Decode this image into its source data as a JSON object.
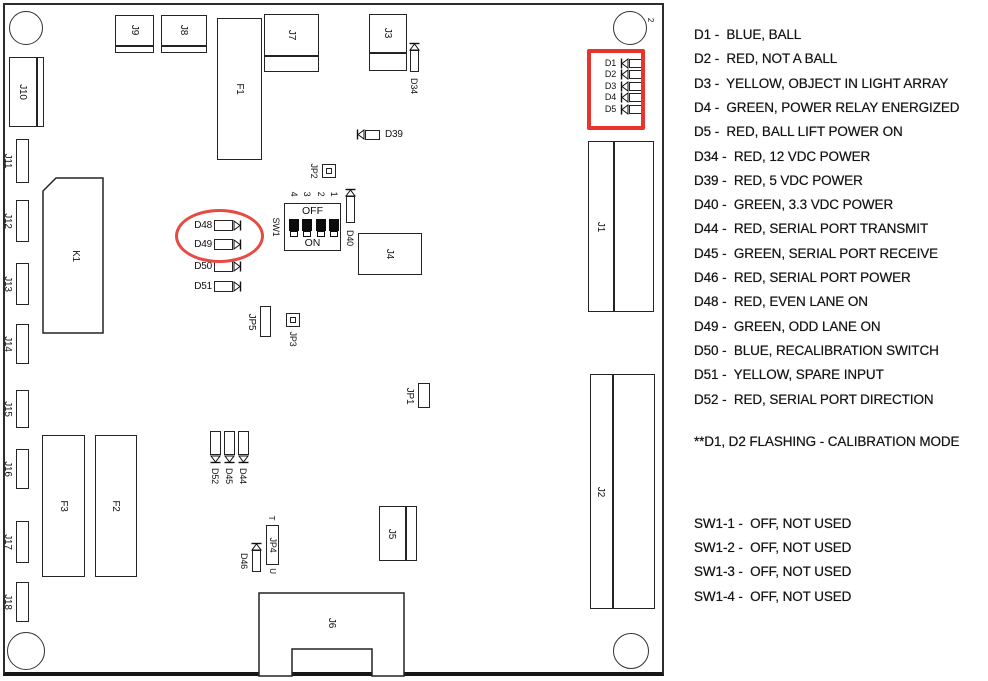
{
  "legend": {
    "led_lines": [
      "D1 -  BLUE, BALL",
      "D2 -  RED, NOT A BALL",
      "D3 -  YELLOW, OBJECT IN LIGHT ARRAY",
      "D4 -  GREEN, POWER RELAY ENERGIZED",
      "D5 -  RED, BALL LIFT POWER ON",
      "D34 -  RED, 12 VDC POWER",
      "D39 -  RED, 5 VDC POWER",
      "D40 -  GREEN, 3.3 VDC POWER",
      "D44 -  RED, SERIAL PORT TRANSMIT",
      "D45 -  GREEN, SERIAL PORT RECEIVE",
      "D46 -  RED, SERIAL PORT POWER",
      "D48 -  RED, EVEN LANE ON",
      "D49 -  GREEN, ODD LANE ON",
      "D50 -  BLUE, RECALIBRATION SWITCH",
      "D51 -  YELLOW, SPARE INPUT",
      "D52 -  RED, SERIAL PORT DIRECTION"
    ],
    "note": "**D1, D2 FLASHING - CALIBRATION MODE",
    "sw_lines": [
      "SW1-1 -  OFF, NOT USED",
      "SW1-2 -  OFF, NOT USED",
      "SW1-3 -  OFF, NOT USED",
      "SW1-4 -  OFF, NOT USED"
    ]
  },
  "board": {
    "outline": {
      "x": 3,
      "y": 3,
      "w": 661,
      "h": 673
    },
    "line_color": "#242424",
    "highlight_rect_color": "#e7342c",
    "highlight_ellipse_color": "#e64a42",
    "holes": [
      {
        "cx": 26,
        "cy": 28,
        "r": 17
      },
      {
        "cx": 630,
        "cy": 28,
        "r": 17
      },
      {
        "cx": 26,
        "cy": 651,
        "r": 19
      },
      {
        "cx": 631,
        "cy": 651,
        "r": 18
      }
    ],
    "connectors": [
      {
        "id": "J10",
        "x": 9,
        "y": 57,
        "w": 35,
        "h": 70,
        "vdiv": 27
      },
      {
        "id": "J9",
        "x": 115,
        "y": 15,
        "w": 39,
        "h": 38,
        "hdiv": 30
      },
      {
        "id": "J8",
        "x": 161,
        "y": 15,
        "w": 46,
        "h": 38,
        "hdiv": 30
      },
      {
        "id": "J7",
        "x": 264,
        "y": 14,
        "w": 55,
        "h": 58,
        "hdiv": 41
      },
      {
        "id": "J3",
        "x": 369,
        "y": 14,
        "w": 38,
        "h": 57,
        "hdiv": 38
      },
      {
        "id": "F1",
        "x": 217,
        "y": 18,
        "w": 45,
        "h": 142
      },
      {
        "id": "J4",
        "x": 358,
        "y": 233,
        "w": 64,
        "h": 42
      },
      {
        "id": "F3",
        "x": 42,
        "y": 435,
        "w": 43,
        "h": 142
      },
      {
        "id": "F2",
        "x": 95,
        "y": 435,
        "w": 42,
        "h": 142
      },
      {
        "id": "J5",
        "x": 379,
        "y": 506,
        "w": 38,
        "h": 55,
        "vdiv": 26
      },
      {
        "id": "J1",
        "x": 588,
        "y": 141,
        "w": 66,
        "h": 171,
        "vdiv": 25
      },
      {
        "id": "J2",
        "x": 590,
        "y": 374,
        "w": 65,
        "h": 235,
        "vdiv": 22
      },
      {
        "id": "J11",
        "x": 16,
        "y": 139,
        "w": 13,
        "h": 44,
        "labelOut": "left"
      },
      {
        "id": "J12",
        "x": 16,
        "y": 200,
        "w": 13,
        "h": 42,
        "labelOut": "left"
      },
      {
        "id": "J13",
        "x": 16,
        "y": 263,
        "w": 13,
        "h": 42,
        "labelOut": "left"
      },
      {
        "id": "J14",
        "x": 16,
        "y": 324,
        "w": 13,
        "h": 40,
        "labelOut": "left"
      },
      {
        "id": "J15",
        "x": 16,
        "y": 390,
        "w": 13,
        "h": 38,
        "labelOut": "left"
      },
      {
        "id": "J16",
        "x": 16,
        "y": 449,
        "w": 13,
        "h": 40,
        "labelOut": "left"
      },
      {
        "id": "J17",
        "x": 16,
        "y": 521,
        "w": 13,
        "h": 42,
        "labelOut": "left"
      },
      {
        "id": "J18",
        "x": 16,
        "y": 582,
        "w": 13,
        "h": 40,
        "labelOut": "left"
      },
      {
        "id": "JP5",
        "x": 260,
        "y": 306,
        "w": 11,
        "h": 31,
        "labelOut": "left"
      },
      {
        "id": "JP1",
        "x": 418,
        "y": 383,
        "w": 12,
        "h": 25,
        "labelOut": "left"
      },
      {
        "id": "JP4",
        "x": 266,
        "y": 525,
        "w": 13,
        "h": 40,
        "labelIn": true,
        "topMark": "T",
        "bottomMark": "U"
      }
    ],
    "notched_relay": {
      "id": "K1",
      "x": 43,
      "y": 178,
      "w": 60,
      "h": 155,
      "notch": 13
    },
    "j6": {
      "id": "J6",
      "x": 258,
      "y": 592,
      "w": 147,
      "h": 85,
      "bodyH": 57,
      "legW": 33
    },
    "jumper_squares": [
      {
        "id": "JP2",
        "x": 322,
        "y": 164,
        "s": 14,
        "labelOut": "left"
      },
      {
        "id": "JP3",
        "x": 286,
        "y": 313,
        "s": 14,
        "labelOut": "bottom"
      }
    ],
    "leds_h": [
      {
        "id": "D1",
        "body": [
          629,
          59,
          15,
          9
        ],
        "diode": [
          620,
          58,
          "left"
        ],
        "label": [
          596,
          58,
          20,
          10,
          "right"
        ],
        "fs": 9
      },
      {
        "id": "D2",
        "body": [
          629,
          70,
          15,
          9
        ],
        "diode": [
          620,
          69,
          "left"
        ],
        "label": [
          596,
          69,
          20,
          10,
          "right"
        ],
        "fs": 9
      },
      {
        "id": "D3",
        "body": [
          629,
          82,
          15,
          9
        ],
        "diode": [
          620,
          81,
          "left"
        ],
        "label": [
          596,
          81,
          20,
          10,
          "right"
        ],
        "fs": 9
      },
      {
        "id": "D4",
        "body": [
          629,
          93,
          15,
          9
        ],
        "diode": [
          620,
          92,
          "left"
        ],
        "label": [
          596,
          92,
          20,
          10,
          "right"
        ],
        "fs": 9
      },
      {
        "id": "D5",
        "body": [
          629,
          105,
          15,
          9
        ],
        "diode": [
          620,
          104,
          "left"
        ],
        "label": [
          596,
          104,
          20,
          10,
          "right"
        ],
        "fs": 9
      },
      {
        "id": "D39",
        "body": [
          365,
          130,
          15,
          10
        ],
        "diode": [
          356,
          129,
          "left"
        ],
        "label": [
          385,
          129,
          36,
          11,
          "left"
        ],
        "fs": 10
      },
      {
        "id": "D48",
        "body": [
          214,
          220,
          19,
          11
        ],
        "diode": [
          233,
          220,
          "right"
        ],
        "label": [
          188,
          220,
          24,
          11,
          "right"
        ],
        "fs": 10
      },
      {
        "id": "D49",
        "body": [
          214,
          239,
          19,
          11
        ],
        "diode": [
          233,
          239,
          "right"
        ],
        "label": [
          188,
          239,
          24,
          11,
          "right"
        ],
        "fs": 10
      },
      {
        "id": "D50",
        "body": [
          214,
          261,
          19,
          11
        ],
        "diode": [
          233,
          261,
          "right"
        ],
        "label": [
          188,
          261,
          24,
          11,
          "right"
        ],
        "fs": 10
      },
      {
        "id": "D51",
        "body": [
          214,
          281,
          19,
          11
        ],
        "diode": [
          233,
          281,
          "right"
        ],
        "label": [
          188,
          281,
          24,
          11,
          "right"
        ],
        "fs": 10
      }
    ],
    "leds_v": [
      {
        "id": "D34",
        "body": [
          410,
          50,
          9,
          22
        ],
        "diode": [
          409,
          42,
          "up"
        ],
        "vlabel": [
          414,
          86
        ]
      },
      {
        "id": "D40",
        "body": [
          346,
          196,
          9,
          27
        ],
        "diode": [
          345,
          188,
          "up"
        ],
        "vlabel": [
          350,
          238
        ]
      },
      {
        "id": "D46",
        "body": [
          252,
          550,
          9,
          22
        ],
        "diode": [
          251,
          542,
          "up"
        ],
        "vlabel": [
          244,
          561
        ]
      },
      {
        "id": "D44",
        "body": [
          238,
          431,
          11,
          24
        ],
        "diode": [
          238,
          455,
          "down"
        ],
        "vlabel": [
          243,
          476
        ]
      },
      {
        "id": "D45",
        "body": [
          224,
          431,
          11,
          24
        ],
        "diode": [
          224,
          455,
          "down"
        ],
        "vlabel": [
          229,
          476
        ]
      },
      {
        "id": "D52",
        "body": [
          210,
          431,
          11,
          24
        ],
        "diode": [
          210,
          455,
          "down"
        ],
        "vlabel": [
          215,
          476
        ]
      }
    ],
    "dip_switch": {
      "id": "SW1",
      "x": 284,
      "y": 203,
      "w": 57,
      "h": 48,
      "off_label": "OFF",
      "on_label": "ON",
      "numbers": [
        "4",
        "3",
        "2",
        "1"
      ],
      "states": [
        "OFF",
        "OFF",
        "OFF",
        "OFF"
      ]
    },
    "highlights": {
      "rect": {
        "x": 587,
        "y": 49,
        "w": 58,
        "h": 81
      },
      "ellipse": {
        "x": 175,
        "y": 209,
        "w": 89,
        "h": 54
      }
    },
    "corner_mark": {
      "text": "2",
      "x": 651,
      "y": 20
    }
  }
}
